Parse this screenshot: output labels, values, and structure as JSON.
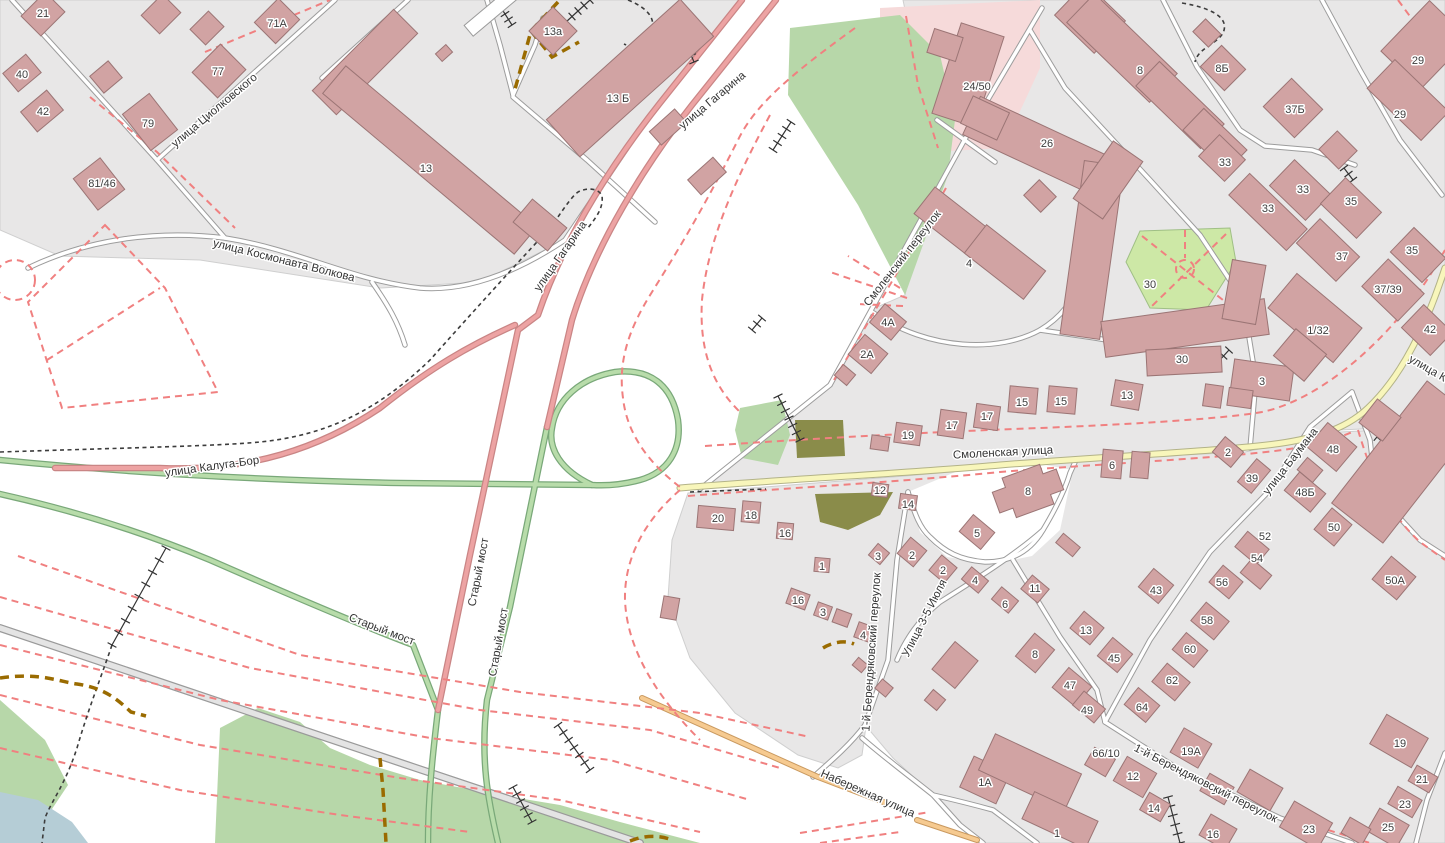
{
  "map": {
    "colors": {
      "building": "#d1a3a3",
      "building_stroke": "#9b7575",
      "residential": "#e8e7e7",
      "park": "#b7d7a9",
      "park_light": "#cde8a6",
      "pink_area": "#f6dada",
      "water": "#b5cdd6",
      "olive": "#8a8c4a",
      "road_pink": "#eda3a3",
      "road_green": "#b8dcaa",
      "road_yellow": "#f8f6bb",
      "road_orange": "#f6ca90",
      "dash_pink": "#f08080",
      "dash_brown": "#9a6b00"
    },
    "street_labels": [
      {
        "text": "улица Циолковского",
        "x": 214,
        "y": 110,
        "r": -40
      },
      {
        "text": "улица Космонавта Волкова",
        "x": 284,
        "y": 260,
        "r": 14
      },
      {
        "text": "улица Гагарина",
        "x": 712,
        "y": 100,
        "r": -40
      },
      {
        "text": "улица Гагарина",
        "x": 560,
        "y": 256,
        "r": -55
      },
      {
        "text": "Смоленский переулок",
        "x": 902,
        "y": 258,
        "r": -52
      },
      {
        "text": "Смоленская улица",
        "x": 1003,
        "y": 452,
        "r": -3
      },
      {
        "text": "улица Калуга-Бор",
        "x": 212,
        "y": 466,
        "r": -8
      },
      {
        "text": "Старый мост",
        "x": 478,
        "y": 572,
        "r": -79
      },
      {
        "text": "Старый мост",
        "x": 498,
        "y": 642,
        "r": -80
      },
      {
        "text": "Старый мост",
        "x": 382,
        "y": 629,
        "r": 21
      },
      {
        "text": "улица Баумана",
        "x": 1290,
        "y": 461,
        "r": -52
      },
      {
        "text": "улица К",
        "x": 1428,
        "y": 368,
        "r": 30
      },
      {
        "text": "1-й Берендяковский переулок",
        "x": 871,
        "y": 652,
        "r": -86
      },
      {
        "text": "1-й Берендяковский переулок",
        "x": 1206,
        "y": 783,
        "r": 27
      },
      {
        "text": "Улица 3-5 Июля",
        "x": 924,
        "y": 618,
        "r": -63
      },
      {
        "text": "Набережная улица",
        "x": 868,
        "y": 793,
        "r": 24
      }
    ],
    "building_labels": [
      {
        "t": "21",
        "x": 43,
        "y": 13
      },
      {
        "t": "71А",
        "x": 277,
        "y": 23
      },
      {
        "t": "40",
        "x": 22,
        "y": 74
      },
      {
        "t": "42",
        "x": 43,
        "y": 111
      },
      {
        "t": "77",
        "x": 218,
        "y": 71
      },
      {
        "t": "79",
        "x": 148,
        "y": 123
      },
      {
        "t": "81/46",
        "x": 102,
        "y": 183
      },
      {
        "t": "13",
        "x": 426,
        "y": 168
      },
      {
        "t": "13а",
        "x": 553,
        "y": 31
      },
      {
        "t": "13 Б",
        "x": 618,
        "y": 98
      },
      {
        "t": "24/50",
        "x": 977,
        "y": 86
      },
      {
        "t": "8",
        "x": 1140,
        "y": 70
      },
      {
        "t": "8Б",
        "x": 1222,
        "y": 68
      },
      {
        "t": "37Б",
        "x": 1295,
        "y": 109
      },
      {
        "t": "29",
        "x": 1418,
        "y": 60
      },
      {
        "t": "29",
        "x": 1400,
        "y": 114
      },
      {
        "t": "26",
        "x": 1047,
        "y": 143
      },
      {
        "t": "33",
        "x": 1225,
        "y": 162
      },
      {
        "t": "33",
        "x": 1303,
        "y": 189
      },
      {
        "t": "33",
        "x": 1268,
        "y": 208
      },
      {
        "t": "35",
        "x": 1351,
        "y": 201
      },
      {
        "t": "35",
        "x": 1412,
        "y": 250
      },
      {
        "t": "37",
        "x": 1342,
        "y": 256
      },
      {
        "t": "37/39",
        "x": 1388,
        "y": 289
      },
      {
        "t": "42",
        "x": 1430,
        "y": 329
      },
      {
        "t": "4",
        "x": 969,
        "y": 263
      },
      {
        "t": "4А",
        "x": 888,
        "y": 322
      },
      {
        "t": "2А",
        "x": 867,
        "y": 354
      },
      {
        "t": "30",
        "x": 1150,
        "y": 284
      },
      {
        "t": "30",
        "x": 1182,
        "y": 359
      },
      {
        "t": "13",
        "x": 1127,
        "y": 395
      },
      {
        "t": "3",
        "x": 1262,
        "y": 381
      },
      {
        "t": "1/32",
        "x": 1318,
        "y": 330
      },
      {
        "t": "15",
        "x": 1022,
        "y": 402
      },
      {
        "t": "15",
        "x": 1061,
        "y": 401
      },
      {
        "t": "17",
        "x": 987,
        "y": 416
      },
      {
        "t": "17",
        "x": 952,
        "y": 425
      },
      {
        "t": "19",
        "x": 908,
        "y": 435
      },
      {
        "t": "12",
        "x": 880,
        "y": 490
      },
      {
        "t": "14",
        "x": 908,
        "y": 504
      },
      {
        "t": "5",
        "x": 977,
        "y": 533
      },
      {
        "t": "8",
        "x": 1028,
        "y": 491
      },
      {
        "t": "6",
        "x": 1112,
        "y": 465
      },
      {
        "t": "2",
        "x": 1228,
        "y": 452
      },
      {
        "t": "39",
        "x": 1252,
        "y": 478
      },
      {
        "t": "48",
        "x": 1333,
        "y": 449
      },
      {
        "t": "48Б",
        "x": 1305,
        "y": 492
      },
      {
        "t": "50",
        "x": 1334,
        "y": 527
      },
      {
        "t": "50А",
        "x": 1395,
        "y": 580
      },
      {
        "t": "52",
        "x": 1265,
        "y": 536
      },
      {
        "t": "54",
        "x": 1257,
        "y": 558
      },
      {
        "t": "56",
        "x": 1222,
        "y": 582
      },
      {
        "t": "58",
        "x": 1207,
        "y": 620
      },
      {
        "t": "60",
        "x": 1190,
        "y": 649
      },
      {
        "t": "62",
        "x": 1172,
        "y": 680
      },
      {
        "t": "64",
        "x": 1142,
        "y": 707
      },
      {
        "t": "43",
        "x": 1156,
        "y": 590
      },
      {
        "t": "13",
        "x": 1086,
        "y": 630
      },
      {
        "t": "45",
        "x": 1114,
        "y": 658
      },
      {
        "t": "47",
        "x": 1070,
        "y": 685
      },
      {
        "t": "49",
        "x": 1087,
        "y": 710
      },
      {
        "t": "11",
        "x": 1035,
        "y": 588
      },
      {
        "t": "8",
        "x": 1035,
        "y": 654
      },
      {
        "t": "6",
        "x": 1005,
        "y": 604
      },
      {
        "t": "20",
        "x": 718,
        "y": 518
      },
      {
        "t": "18",
        "x": 751,
        "y": 515
      },
      {
        "t": "16",
        "x": 785,
        "y": 533
      },
      {
        "t": "1",
        "x": 822,
        "y": 566
      },
      {
        "t": "3",
        "x": 878,
        "y": 556
      },
      {
        "t": "2",
        "x": 912,
        "y": 555
      },
      {
        "t": "2",
        "x": 943,
        "y": 570
      },
      {
        "t": "4",
        "x": 975,
        "y": 580
      },
      {
        "t": "16",
        "x": 798,
        "y": 600
      },
      {
        "t": "3",
        "x": 823,
        "y": 612
      },
      {
        "t": "4",
        "x": 863,
        "y": 635
      },
      {
        "t": "66/10",
        "x": 1106,
        "y": 753
      },
      {
        "t": "12",
        "x": 1133,
        "y": 776
      },
      {
        "t": "14",
        "x": 1154,
        "y": 808
      },
      {
        "t": "19А",
        "x": 1191,
        "y": 751
      },
      {
        "t": "19",
        "x": 1217,
        "y": 790
      },
      {
        "t": "16",
        "x": 1213,
        "y": 834
      },
      {
        "t": "23",
        "x": 1309,
        "y": 829
      },
      {
        "t": "25",
        "x": 1388,
        "y": 827
      },
      {
        "t": "23",
        "x": 1405,
        "y": 804
      },
      {
        "t": "21",
        "x": 1422,
        "y": 779
      },
      {
        "t": "19",
        "x": 1400,
        "y": 743
      },
      {
        "t": "1А",
        "x": 985,
        "y": 782
      },
      {
        "t": "1",
        "x": 1057,
        "y": 833
      }
    ]
  }
}
